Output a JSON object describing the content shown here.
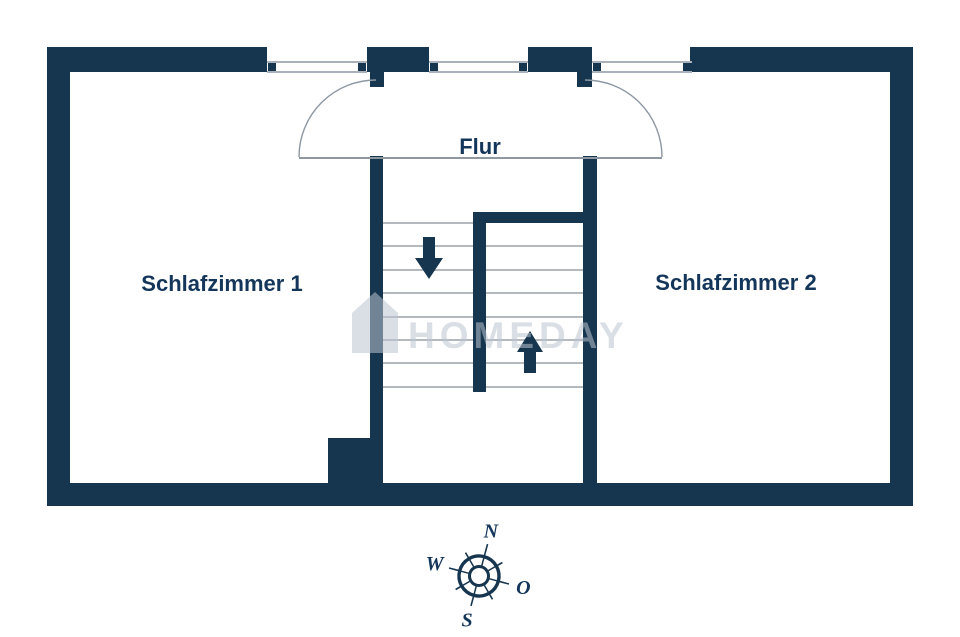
{
  "rooms": {
    "room1": "Schlafzimmer 1",
    "hall": "Flur",
    "room2": "Schlafzimmer 2"
  },
  "stairs": {
    "down_arrow": "down",
    "up_arrow": "up"
  },
  "compass": {
    "north": "N",
    "west": "W",
    "east": "O",
    "south": "S"
  },
  "watermark": {
    "text": "HOMEDAY"
  },
  "colors": {
    "wall": "#16364f",
    "label": "#14365b",
    "tread": "#b4b9be",
    "line": "#8d98a3",
    "window": "#a9b2ba",
    "watermark": "rgba(188,197,208,0.55)"
  }
}
